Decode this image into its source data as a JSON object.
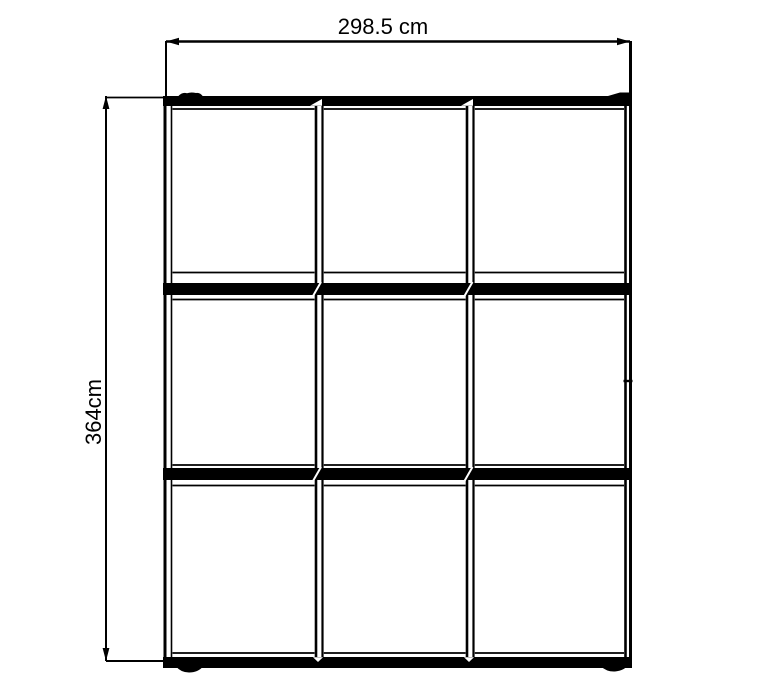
{
  "page": {
    "background_color": "#ffffff",
    "line_color": "#000000"
  },
  "dimensions": {
    "width_label": "298.5 cm",
    "height_label": "364cm"
  },
  "diagram": {
    "type": "technical-drawing",
    "subject": "3x3 panel wardrobe front elevation",
    "grid_rows": 3,
    "grid_columns": 3
  }
}
